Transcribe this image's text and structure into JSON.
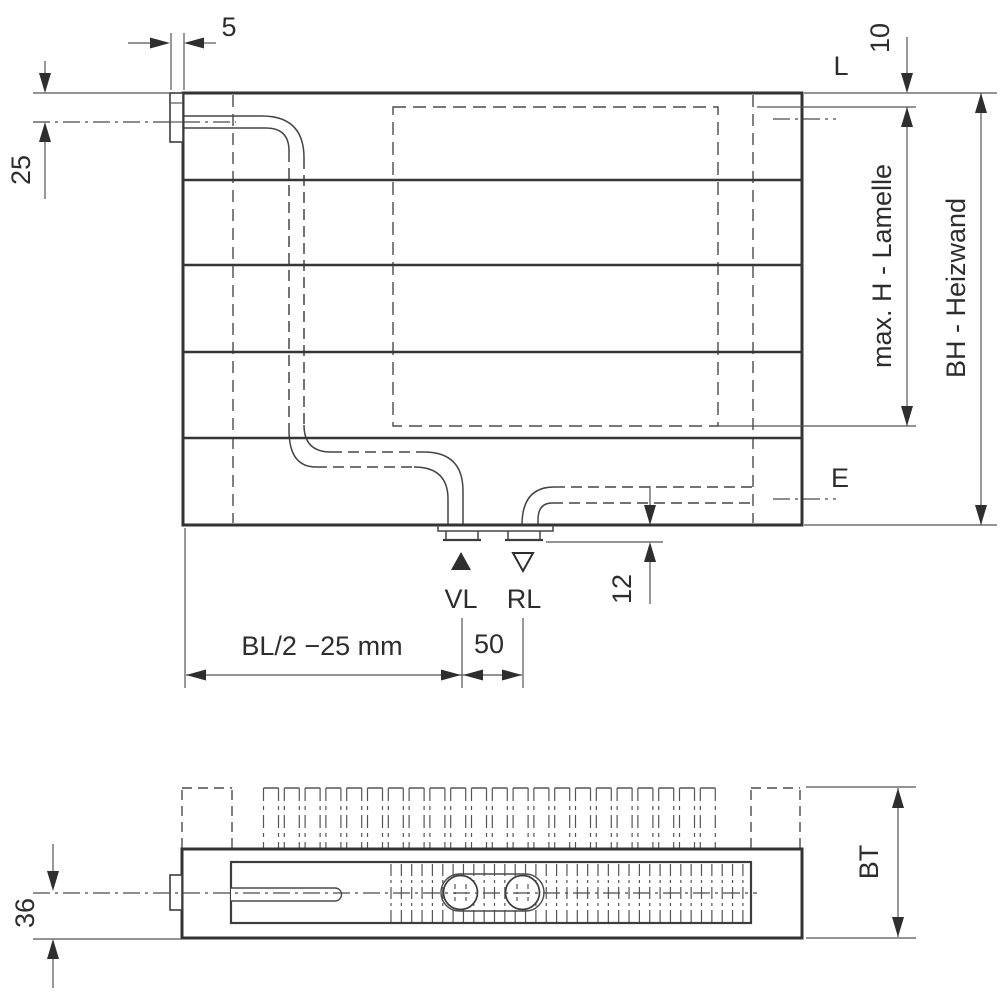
{
  "colors": {
    "line": "#333333",
    "line_thin": "#4a4a4a",
    "background": "#ffffff"
  },
  "front_view": {
    "name": "Heizwand front view",
    "labels": {
      "bracket_width": "5",
      "pipe_axis_offset": "25",
      "lamelle_top_gap": "10",
      "vent_connection": "L",
      "drain_connection": "E",
      "max_lamelle_height": "max. H - Lamelle",
      "heizwand_height": "BH - Heizwand",
      "flow": "VL",
      "return": "RL",
      "connector_projection": "12",
      "flow_position": "BL/2 −25 mm",
      "connector_spacing": "50"
    }
  },
  "top_view": {
    "name": "Heizwand top view",
    "labels": {
      "axis_to_front": "36",
      "build_depth": "BT"
    }
  }
}
